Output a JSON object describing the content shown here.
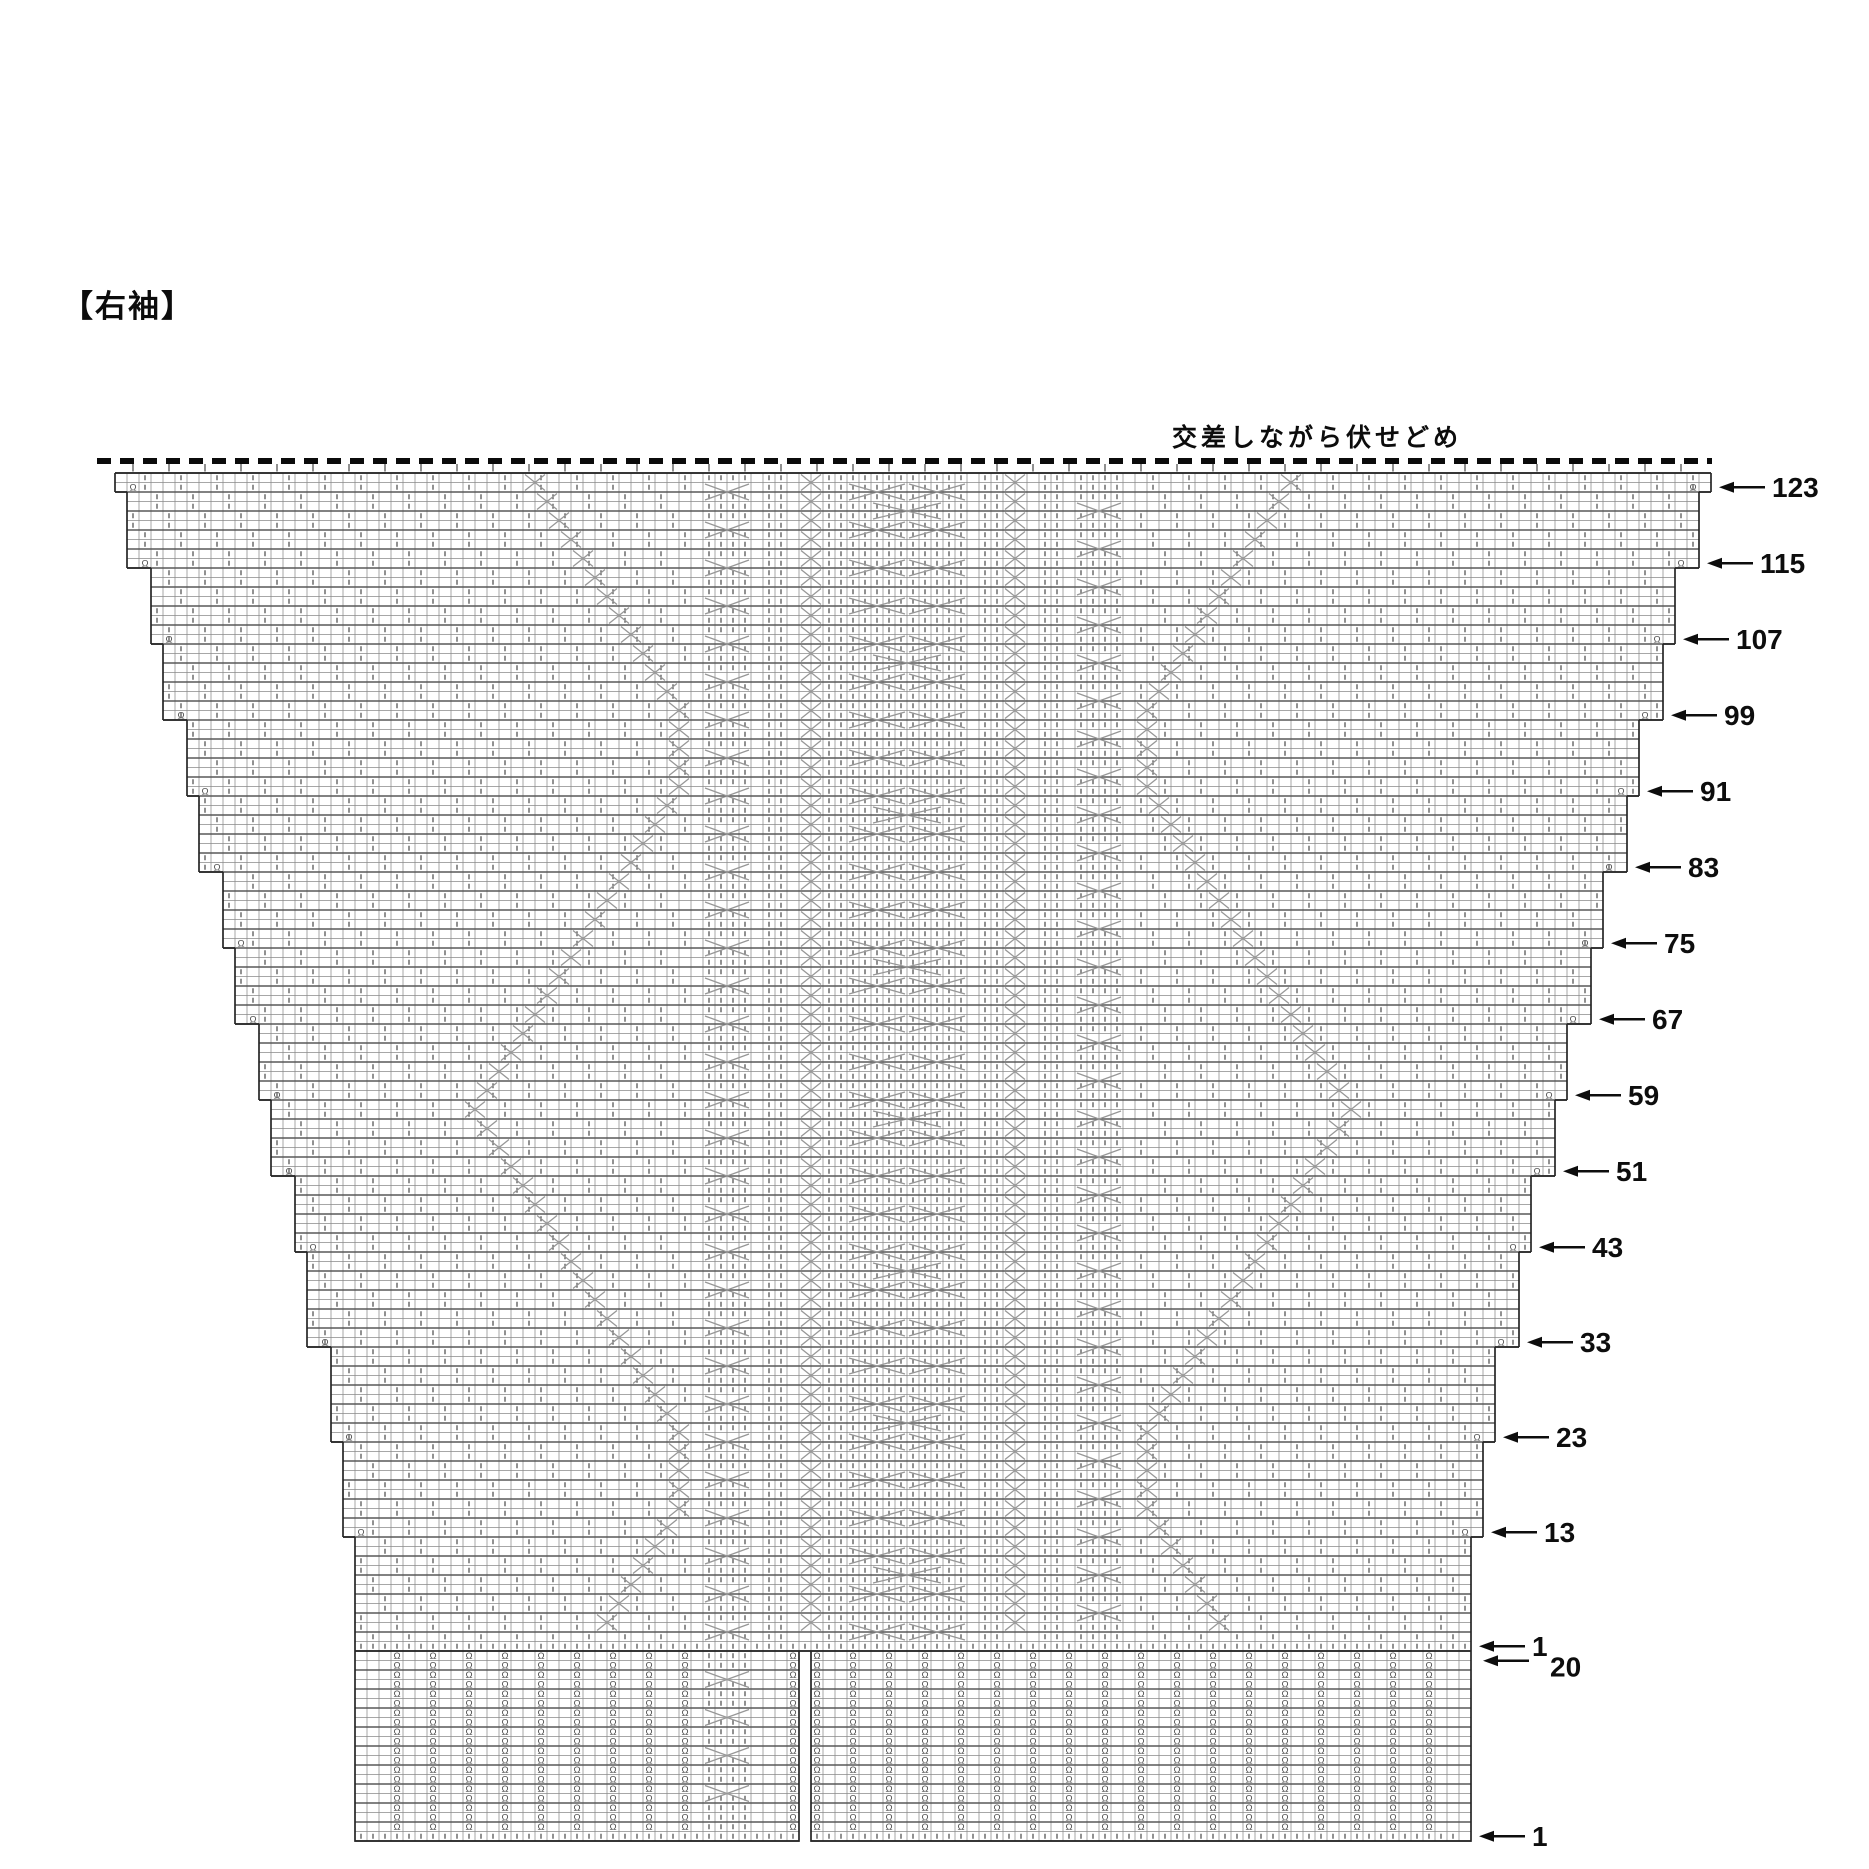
{
  "title": "【右袖】",
  "bind_off_label": "交差しながら伏せどめ",
  "symbols": {
    "knit_tick": "|",
    "twist_stitch": "Ω"
  },
  "colors": {
    "grid": "#8b8b8b",
    "grid_bold": "#585858",
    "border": "#262626",
    "tick": "#4f4f4f",
    "cable": "#979797",
    "text": "#0d0d0d"
  },
  "row_markers": [
    {
      "label": "123",
      "row": 123,
      "step_below": 1
    },
    {
      "label": "115",
      "row": 115,
      "step_below": 2
    },
    {
      "label": "107",
      "row": 107,
      "step_below": 1
    },
    {
      "label": "99",
      "row": 99,
      "step_below": 2
    },
    {
      "label": "91",
      "row": 91,
      "step_below": 1
    },
    {
      "label": "83",
      "row": 83,
      "step_below": 2
    },
    {
      "label": "75",
      "row": 75,
      "step_below": 1
    },
    {
      "label": "67",
      "row": 67,
      "step_below": 2
    },
    {
      "label": "59",
      "row": 59,
      "step_below": 1
    },
    {
      "label": "51",
      "row": 51,
      "step_below": 2
    },
    {
      "label": "43",
      "row": 43,
      "step_below": 1
    },
    {
      "label": "33",
      "row": 33,
      "step_below": 2
    },
    {
      "label": "23",
      "row": 23,
      "step_below": 1
    },
    {
      "label": "13",
      "row": 13,
      "step_below": 1
    }
  ],
  "bottom_markers": {
    "main_row1": "1",
    "rib_top": "20",
    "rib_bottom": "1"
  },
  "chart": {
    "x0": 115,
    "top_y": 473,
    "cell_w": 12,
    "row_h": 9.5,
    "cols": 133,
    "rows": 124,
    "dash_y": 461,
    "dash_x1": 97,
    "dash_x2": 1712,
    "rib": {
      "rows": 20,
      "panels": [
        [
          20,
          57
        ],
        [
          58,
          113
        ]
      ],
      "omega_cols_start": [
        23,
        58
      ],
      "omega_last": [
        56,
        109
      ],
      "omega_step": 3,
      "cable_col": 49,
      "cable_w": 4,
      "skip_min": 48,
      "skip_max": 53
    },
    "panels": {
      "cable_left": {
        "col": 49,
        "w": 4
      },
      "cable_right": {
        "col": 80,
        "w": 4
      },
      "center": {
        "col": 61,
        "w": 10
      },
      "twist_left_col": 57,
      "twist_right_col": 74,
      "tick_cols": [
        54,
        55,
        59,
        60,
        72,
        73,
        77,
        78
      ],
      "zigzag": {
        "min_col": 29,
        "max_travel": 17,
        "half_period": 38,
        "phase": 24,
        "mirror": 131
      }
    }
  }
}
